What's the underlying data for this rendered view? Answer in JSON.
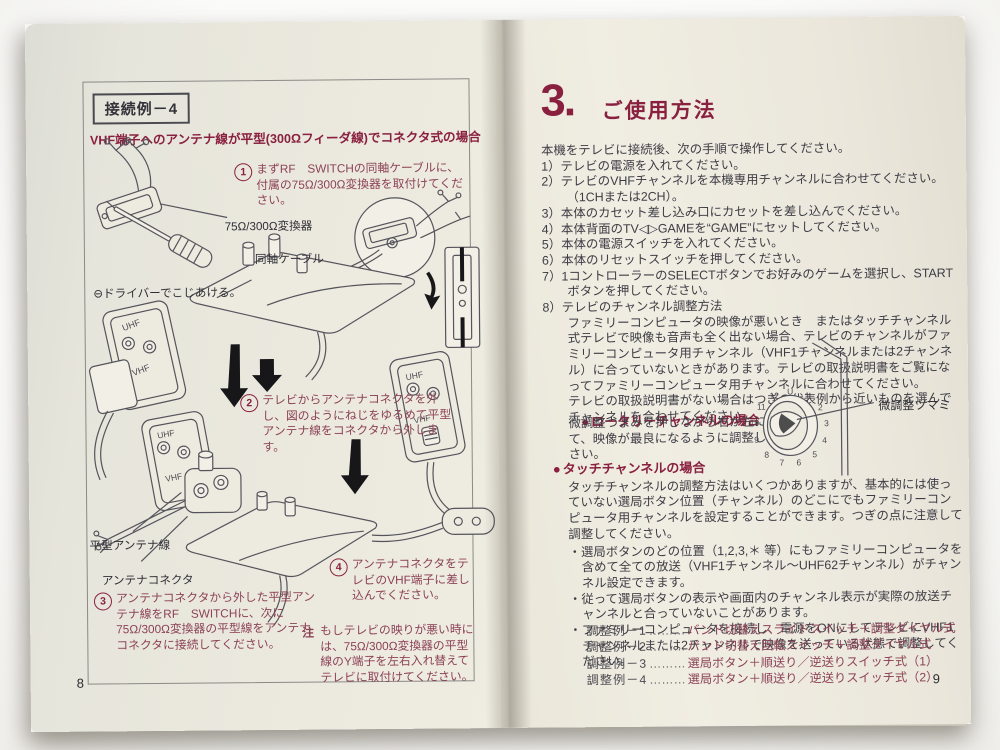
{
  "colors": {
    "heading_red": "#8a2040",
    "body_red": "#8c4256",
    "ink": "#3e3d45",
    "paper_left": "#e9e7dd",
    "paper_right": "#eeebe0"
  },
  "left": {
    "tag": "接続例－4",
    "subtitle": "VHF端子へのアンテナ線が平型(300Ωフィーダ線)でコネクタ式の場合",
    "steps": [
      {
        "num": "1",
        "text": "まずRF　SWITCHの同軸ケーブルに、付属の75Ω/300Ω変換器を取付けてください。"
      },
      {
        "num": "2",
        "text": "テレビからアンテナコネクタを外し、図のようにねじをゆるめて平型アンテナ線をコネクタから外します。"
      },
      {
        "num": "3",
        "text": "アンテナコネクタから外した平型アンテナ線をRF　SWITCHに、次に75Ω/300Ω変換器の平型線をアンテナコネクタに接続してください。"
      },
      {
        "num": "4",
        "text": "アンテナコネクタをテレビのVHF端子に差し込んでください。"
      }
    ],
    "labels": {
      "converter": "75Ω/300Ω変換器",
      "coax": "同軸ケーブル",
      "driver": "⊖ドライバーでこじあける。",
      "flat_wire": "平型アンテナ線",
      "connector": "アンテナコネクタ",
      "uhf": "UHF",
      "vhf": "VHF"
    },
    "note_label": "注",
    "note": "もしテレビの映りが悪い時には、75Ω/300Ω変換器の平型線のY端子を左右入れ替えてテレビに取付けてください。",
    "page_number": "8"
  },
  "right": {
    "section_number": "3.",
    "section_title": "ご使用方法",
    "intro": "本機をテレビに接続後、次の手順で操作してください。",
    "items": [
      "1）テレビの電源を入れてください。",
      "2）テレビのVHFチャンネルを本機専用チャンネルに合わせてください。（1CHまたは2CH）。",
      "3）本体のカセット差し込み口にカセットを差し込んでください。",
      "4）本体背面のTV◁▷GAMEを“GAME”にセットしてください。",
      "5）本体の電源スイッチを入れてください。",
      "6）本体のリセットスイッチを押してください。",
      "7）1コントローラーのSELECTボタンでお好みのゲームを選択し、STARTボタンを押してください。",
      "8）テレビのチャンネル調整方法"
    ],
    "para_8": "ファミリーコンピュータの映像が悪いとき　またはタッチチャンネル式テレビで映像も音声も全く出ない場合、テレビのチャンネルがファミリーコンピュータ用チャンネル（VHF1チャンネルまたは2チャンネル）に合っていないときがあります。テレビの取扱説明書をご覧になってファミリーコンピュータ用チャンネルに合わせてください。",
    "para_8b": "テレビの取扱説明書がない場合はつぎの代表例から近いものを選んでチャンネルを合わせてください。",
    "rotary": {
      "bullet": "●",
      "heading": "ロータリーチャンネルの場合",
      "body": "微調整つまみを押しながら右か左にまわして、映像が最良になるように調整してください。",
      "dial_label": "微調整ツマミ",
      "dial_numbers": [
        "U",
        "1",
        "2",
        "3",
        "4",
        "5",
        "6",
        "7",
        "8",
        "9",
        "10",
        "11",
        "12"
      ]
    },
    "touch": {
      "bullet": "●",
      "heading": "タッチチャンネルの場合",
      "body": "タッチチャンネルの調整方法はいくつかありますが、基本的には使っていない選局ボタン位置（チャンネル）のどこにでもファミリーコンピュータ用チャンネルを設定することができます。つぎの点に注意して調整してください。",
      "bullets": [
        "・選局ボタンのどの位置（1,2,3,＊ 等）にもファミリーコンピュータを含めて全ての放送（VHF1チャンネル〜UHF62チャンネル）がチャンネル設定できます。",
        "・従って選局ボタンの表示や画面内のチャンネル表示が実際の放送チャンネルと合っていないことがあります。",
        "・ファミリーコンピュータを接続し、電源をONにしてテレビにVHF1チャンネルまたは2チャンネルで映像を送っている状態で調整してください。"
      ]
    },
    "examples": [
      {
        "label": "調整例－1",
        "dots": "………",
        "value": "バンド切替えスライドスイッチ＋調整ダイヤル式"
      },
      {
        "label": "調整例－2",
        "dots": "………",
        "value": "バンド切替え回転スイッチ＋調整ダイヤル式"
      },
      {
        "label": "調整例－3",
        "dots": "………",
        "value": "選局ボタン＋順送り／逆送りスイッチ式（1）"
      },
      {
        "label": "調整例－4",
        "dots": "………",
        "value": "選局ボタン＋順送り／逆送りスイッチ式（2）"
      }
    ],
    "page_number": "9"
  }
}
